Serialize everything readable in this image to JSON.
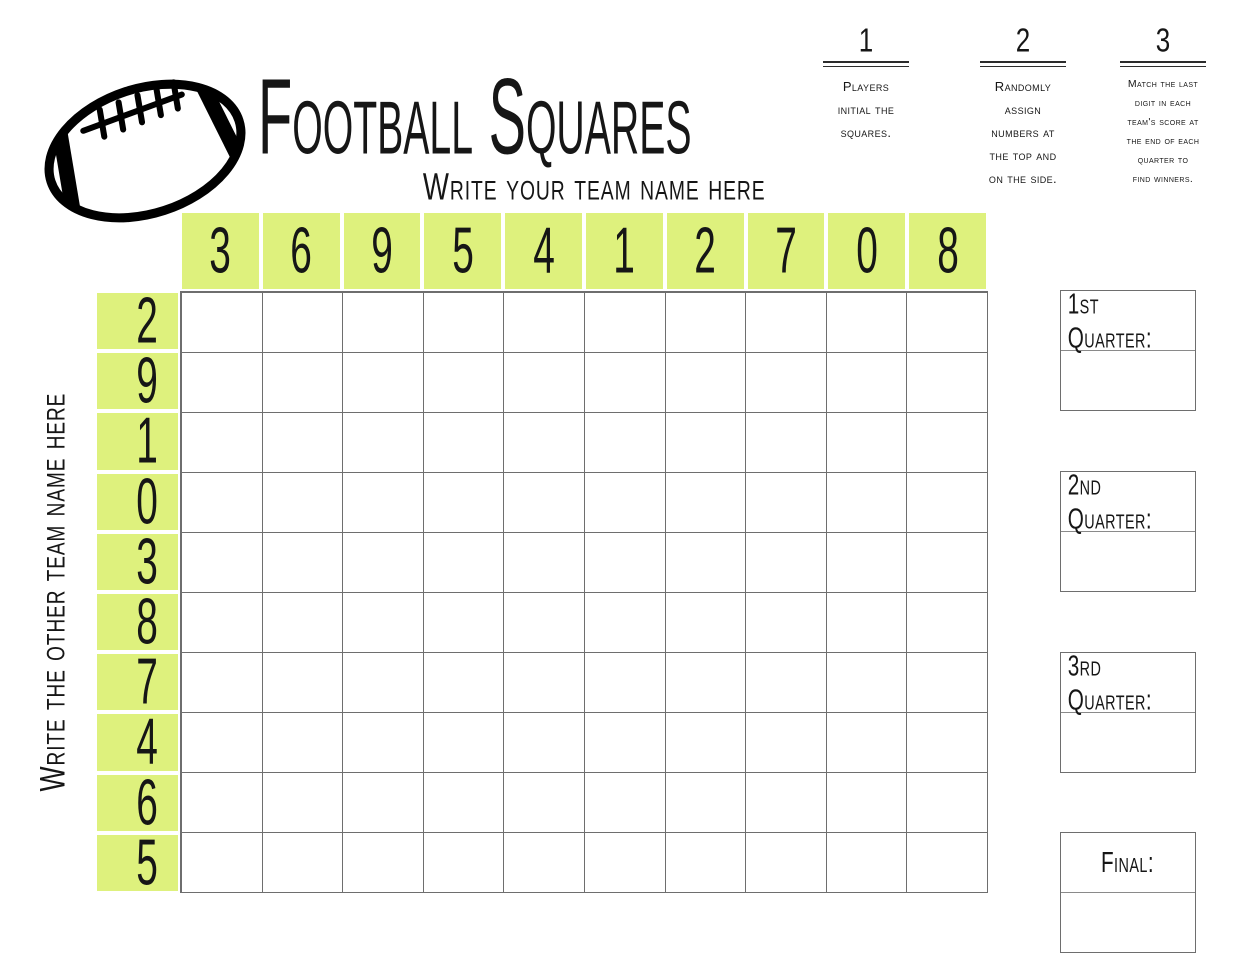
{
  "page": {
    "title": "Football Squares",
    "subtitle": "Write your team name here",
    "side_label": "Write the other team name here"
  },
  "instructions": [
    {
      "number": "1",
      "text": "Players\ninitial the\nsquares."
    },
    {
      "number": "2",
      "text": "Randomly\nassign\nnumbers at\nthe top and\non the side."
    },
    {
      "number": "3",
      "text": "Match the last\ndigit in each\nteam's score at\nthe end of each\nquarter to\nfind winners."
    }
  ],
  "grid": {
    "rows": 10,
    "cols": 10,
    "top_numbers": [
      "3",
      "6",
      "9",
      "5",
      "4",
      "1",
      "2",
      "7",
      "0",
      "8"
    ],
    "side_numbers": [
      "2",
      "9",
      "1",
      "0",
      "3",
      "8",
      "7",
      "4",
      "6",
      "5"
    ]
  },
  "score_boxes": [
    {
      "id": "q1",
      "label": "1st Quarter:"
    },
    {
      "id": "q2",
      "label": "2nd Quarter:"
    },
    {
      "id": "q3",
      "label": "3rd Quarter:"
    },
    {
      "id": "final",
      "label": "Final:"
    }
  ],
  "colors": {
    "highlight_green": "#def17d",
    "grid_line": "#6e6e6e",
    "ink": "#161616"
  }
}
